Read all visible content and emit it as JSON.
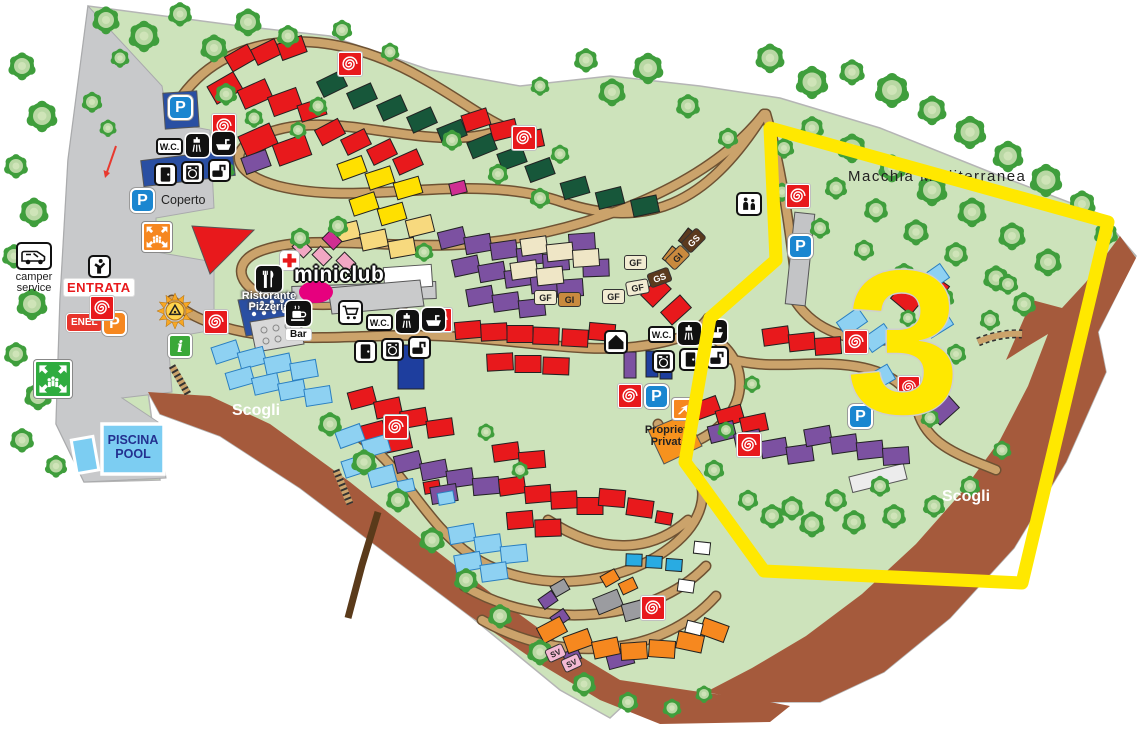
{
  "map": {
    "zone_label": "3",
    "areas": {
      "macchia": "Macchia Mediterranea",
      "scogli": "Scogli",
      "piscina_1": "PISCINA",
      "piscina_2": "POOL",
      "proprieta_1": "Proprietà",
      "proprieta_2": "Privata"
    },
    "entrance": {
      "entrata": "ENTRATA",
      "enel": "ENEL",
      "coperto": "Coperto",
      "camper_1": "camper",
      "camper_2": "service"
    },
    "facilities": {
      "miniclub": "miniclub",
      "ristorante": "Ristorante",
      "pizzeria": "Pizzeria",
      "bar": "Bar",
      "wc": "W.C."
    },
    "pitch_types": {
      "gf": "GF",
      "gi": "GI",
      "gs": "GS",
      "sv": "SV"
    },
    "icons": {
      "parking": "P",
      "info": "i"
    },
    "colors": {
      "zone_outline": "#ffe800",
      "road": "#cba36b",
      "map_green": "#cde3bb",
      "entrance_gray": "#c8c9cb",
      "cliff_brown": "#a55a3c",
      "red_pitch": "#e8191c",
      "purple_pitch": "#7c51a1",
      "blue_pitch": "#8ed1f2",
      "orange_pitch": "#f6881f",
      "darkgreen_pitch": "#17573a",
      "yellow_pitch": "#ffe000"
    }
  }
}
